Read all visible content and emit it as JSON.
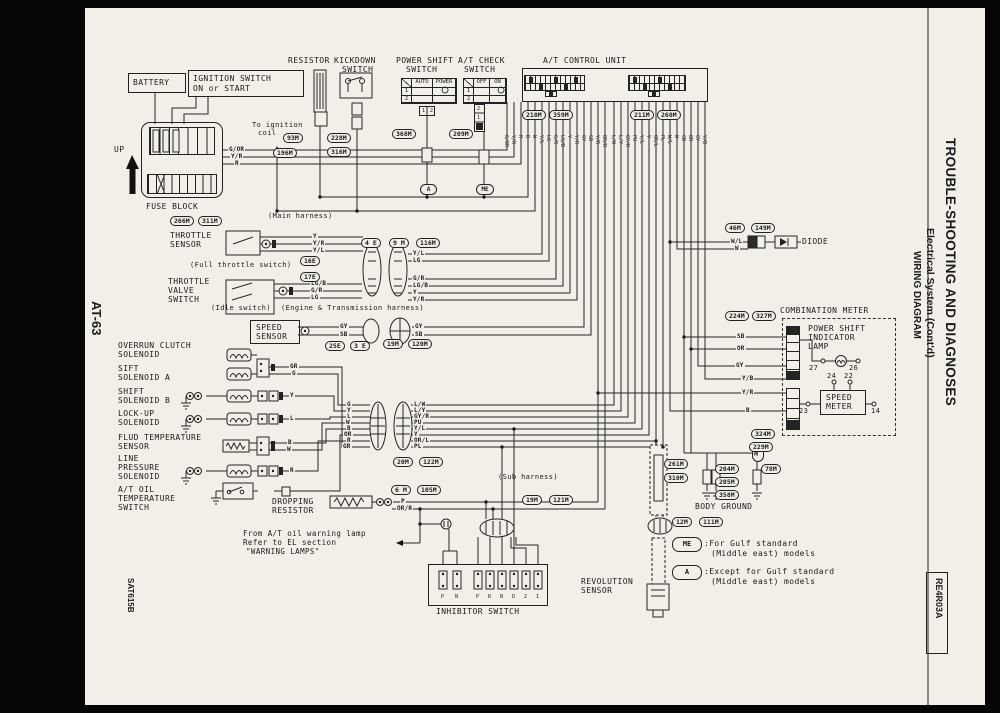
{
  "colors": {
    "paper": "#f2efe8",
    "ink": "#1b1b1b",
    "frame": "#060606"
  },
  "margins": {
    "page_number": "AT-63",
    "photo_code": "SAT615B",
    "ref_code": "RE4R03A"
  },
  "sidebar": {
    "title": "TROUBLE-SHOOTING AND DIAGNOSES",
    "subtitle": "Electrical System (Cont'd)",
    "subtitle2": "WIRING DIAGRAM"
  },
  "labels": {
    "battery": "BATTERY",
    "ignition1": "IGNITION SWITCH",
    "ignition2": "ON or START",
    "resistor": "RESISTOR",
    "kickdown1": "KICKDOWN",
    "kickdown2": "SWITCH",
    "powershift1": "POWER SHIFT",
    "powershift2": "SWITCH",
    "atcheck1": "A/T CHECK",
    "atcheck2": "SWITCH",
    "control_unit": "A/T CONTROL UNIT",
    "up": "UP",
    "fuse_block": "FUSE BLOCK",
    "to_coil1": "To ignition",
    "to_coil2": "coil",
    "main_harness": "(Main harness)",
    "throttle1": "THROTTLE",
    "throttle2": "SENSOR",
    "full_throttle": "(Full throttle switch)",
    "valve1": "THROTTLE",
    "valve2": "VALVE",
    "valve3": "SWITCH",
    "idle": "(Idle switch)",
    "engine_harness": "(Engine & Transmission harness)",
    "speed1": "SPEED",
    "speed2": "SENSOR",
    "overrun1": "OVERRUN CLUTCH",
    "overrun2": "SOLENOID",
    "sift1": "SIFT",
    "sift2": "SOLENOID A",
    "shiftb1": "SHIFT",
    "shiftb2": "SOLENOID B",
    "lockup1": "LOCK-UP",
    "lockup2": "SOLENOID",
    "fluid1": "FLUD TEMPERATURE",
    "fluid2": "SENSOR",
    "linep1": "LINE",
    "linep2": "PRESSURE",
    "linep3": "SOLENOID",
    "atoil1": "A/T OIL",
    "atoil2": "TEMPERATURE",
    "atoil3": "SWITCH",
    "sub_harness": "(Sub harness)",
    "dropping1": "DROPPING",
    "dropping2": "RESISTOR",
    "inhibitor": "INHIBITOR SWITCH",
    "revolution1": "REVOLUTION",
    "revolution2": "SENSOR",
    "note1": "From A/T oil warning lamp",
    "note2": "Refer to EL section",
    "note3": "\"WARNING LAMPS\"",
    "diode": "DIODE",
    "comb_meter": "COMBINATION METER",
    "psi1": "POWER SHIFT",
    "psi2": "INDICATOR",
    "psi3": "LAMP",
    "sm1": "SPEED",
    "sm2": "METER",
    "body_ground": "BODY GROUND"
  },
  "badges": {
    "a": "A",
    "me": "ME",
    "me_vert": "ME",
    "legend_me": "ME",
    "legend_a": "A"
  },
  "legend": {
    "me1": ":For Gulf standard",
    "me2": "(Middle east) models",
    "a1": ":Except for Gulf standard",
    "a2": "(Middle east) models"
  },
  "tables": {
    "ps_col1": "AUTO",
    "ps_col2": "POWER",
    "ps_r1": "1",
    "ps_r2": "2",
    "ps_p1": "1",
    "ps_p2": "2",
    "chk_col1": "OFF",
    "chk_col2": "ON",
    "chk_r1": "1",
    "chk_r2": "2",
    "chk_p1": "2",
    "chk_p2": "1"
  },
  "pins": {
    "lamp_l": "27",
    "lamp_r": "26",
    "sm_t1": "24",
    "sm_t2": "22",
    "sm_l": "23",
    "sm_r": "14",
    "inh": [
      "P",
      "N",
      "P",
      "R",
      "N",
      "D",
      "2",
      "1"
    ]
  },
  "connectors": {
    "c93m": "93M",
    "c196m": "196M",
    "c228m": "228M",
    "c316m": "316M",
    "c368m": "368M",
    "c209m": "209M",
    "c210m": "210M",
    "c359m": "359M",
    "c211m": "211M",
    "c260m": "260M",
    "c266m": "266M",
    "c311m": "311M",
    "c16e": "16E",
    "c17e": "17E",
    "c4e": "4 E",
    "c9m": "9 M",
    "c116m": "116M",
    "c25e": "25E",
    "c3e": "3 E",
    "c19m_a": "19M",
    "c120m": "120M",
    "c20m": "20M",
    "c122m": "122M",
    "c6m": "6 M",
    "c105m": "105M",
    "c19m_b": "19M",
    "c121m": "121M",
    "c46m": "46M",
    "c149m": "149M",
    "c224m": "224M",
    "c327m": "327M",
    "c324m": "324M",
    "c229m": "229M",
    "c261m": "261M",
    "c310m": "310M",
    "c204m": "204M",
    "c205m": "205M",
    "c358m": "358M",
    "c78m": "78M",
    "c12m": "12M",
    "c111m": "111M"
  },
  "wires": {
    "f1": "G/OR",
    "f2": "Y/R",
    "f3": "R",
    "t1": "Y",
    "t2": "Y/R",
    "t3": "Y/L",
    "v1": "LG/B",
    "v2": "G/R",
    "v3": "LG",
    "tr1": "Y/L",
    "tr2": "LG",
    "vr1": "G/R",
    "vr2": "LG/B",
    "vr3": "Y",
    "vr4": "Y/R",
    "s1": "GY",
    "s2": "SB",
    "s3": "GY",
    "s4": "SB",
    "gr": "GR",
    "g": "G",
    "y": "Y",
    "l": "L",
    "b": "B",
    "w": "W",
    "r": "R",
    "bl1": "G",
    "bl2": "Y",
    "bl3": "L",
    "bl4": "W",
    "bl5": "B",
    "bl6": "OR",
    "bl7": "R",
    "bl8": "GR",
    "br1": "L/W",
    "br2": "L/Y",
    "br3": "GY/R",
    "br4": "PU",
    "br5": "Y/L",
    "br6": "Y",
    "br7": "OR/L",
    "br8": "PL",
    "dp1": "P",
    "dp2": "OR/R",
    "d1": "W/L",
    "d2": "W",
    "m1": "SB",
    "m2": "OR",
    "m3": "GY",
    "m4": "Y/B",
    "m5": "Y/R",
    "m6": "B"
  },
  "cu_pins_left": [
    "G/OR",
    "Y/R",
    "R",
    "B",
    "W",
    "Y/L",
    "LG",
    "G/R",
    "LG/B",
    "Y",
    "Y/R",
    "GY",
    "SB",
    "Y/R"
  ],
  "cu_pins_right": [
    "OR/R",
    "L/W",
    "L/Y",
    "GY/R",
    "PU",
    "Y/L",
    "Y",
    "OR/L",
    "PL",
    "W/L",
    "W",
    "SB",
    "OR",
    "GY",
    "Y/B"
  ]
}
